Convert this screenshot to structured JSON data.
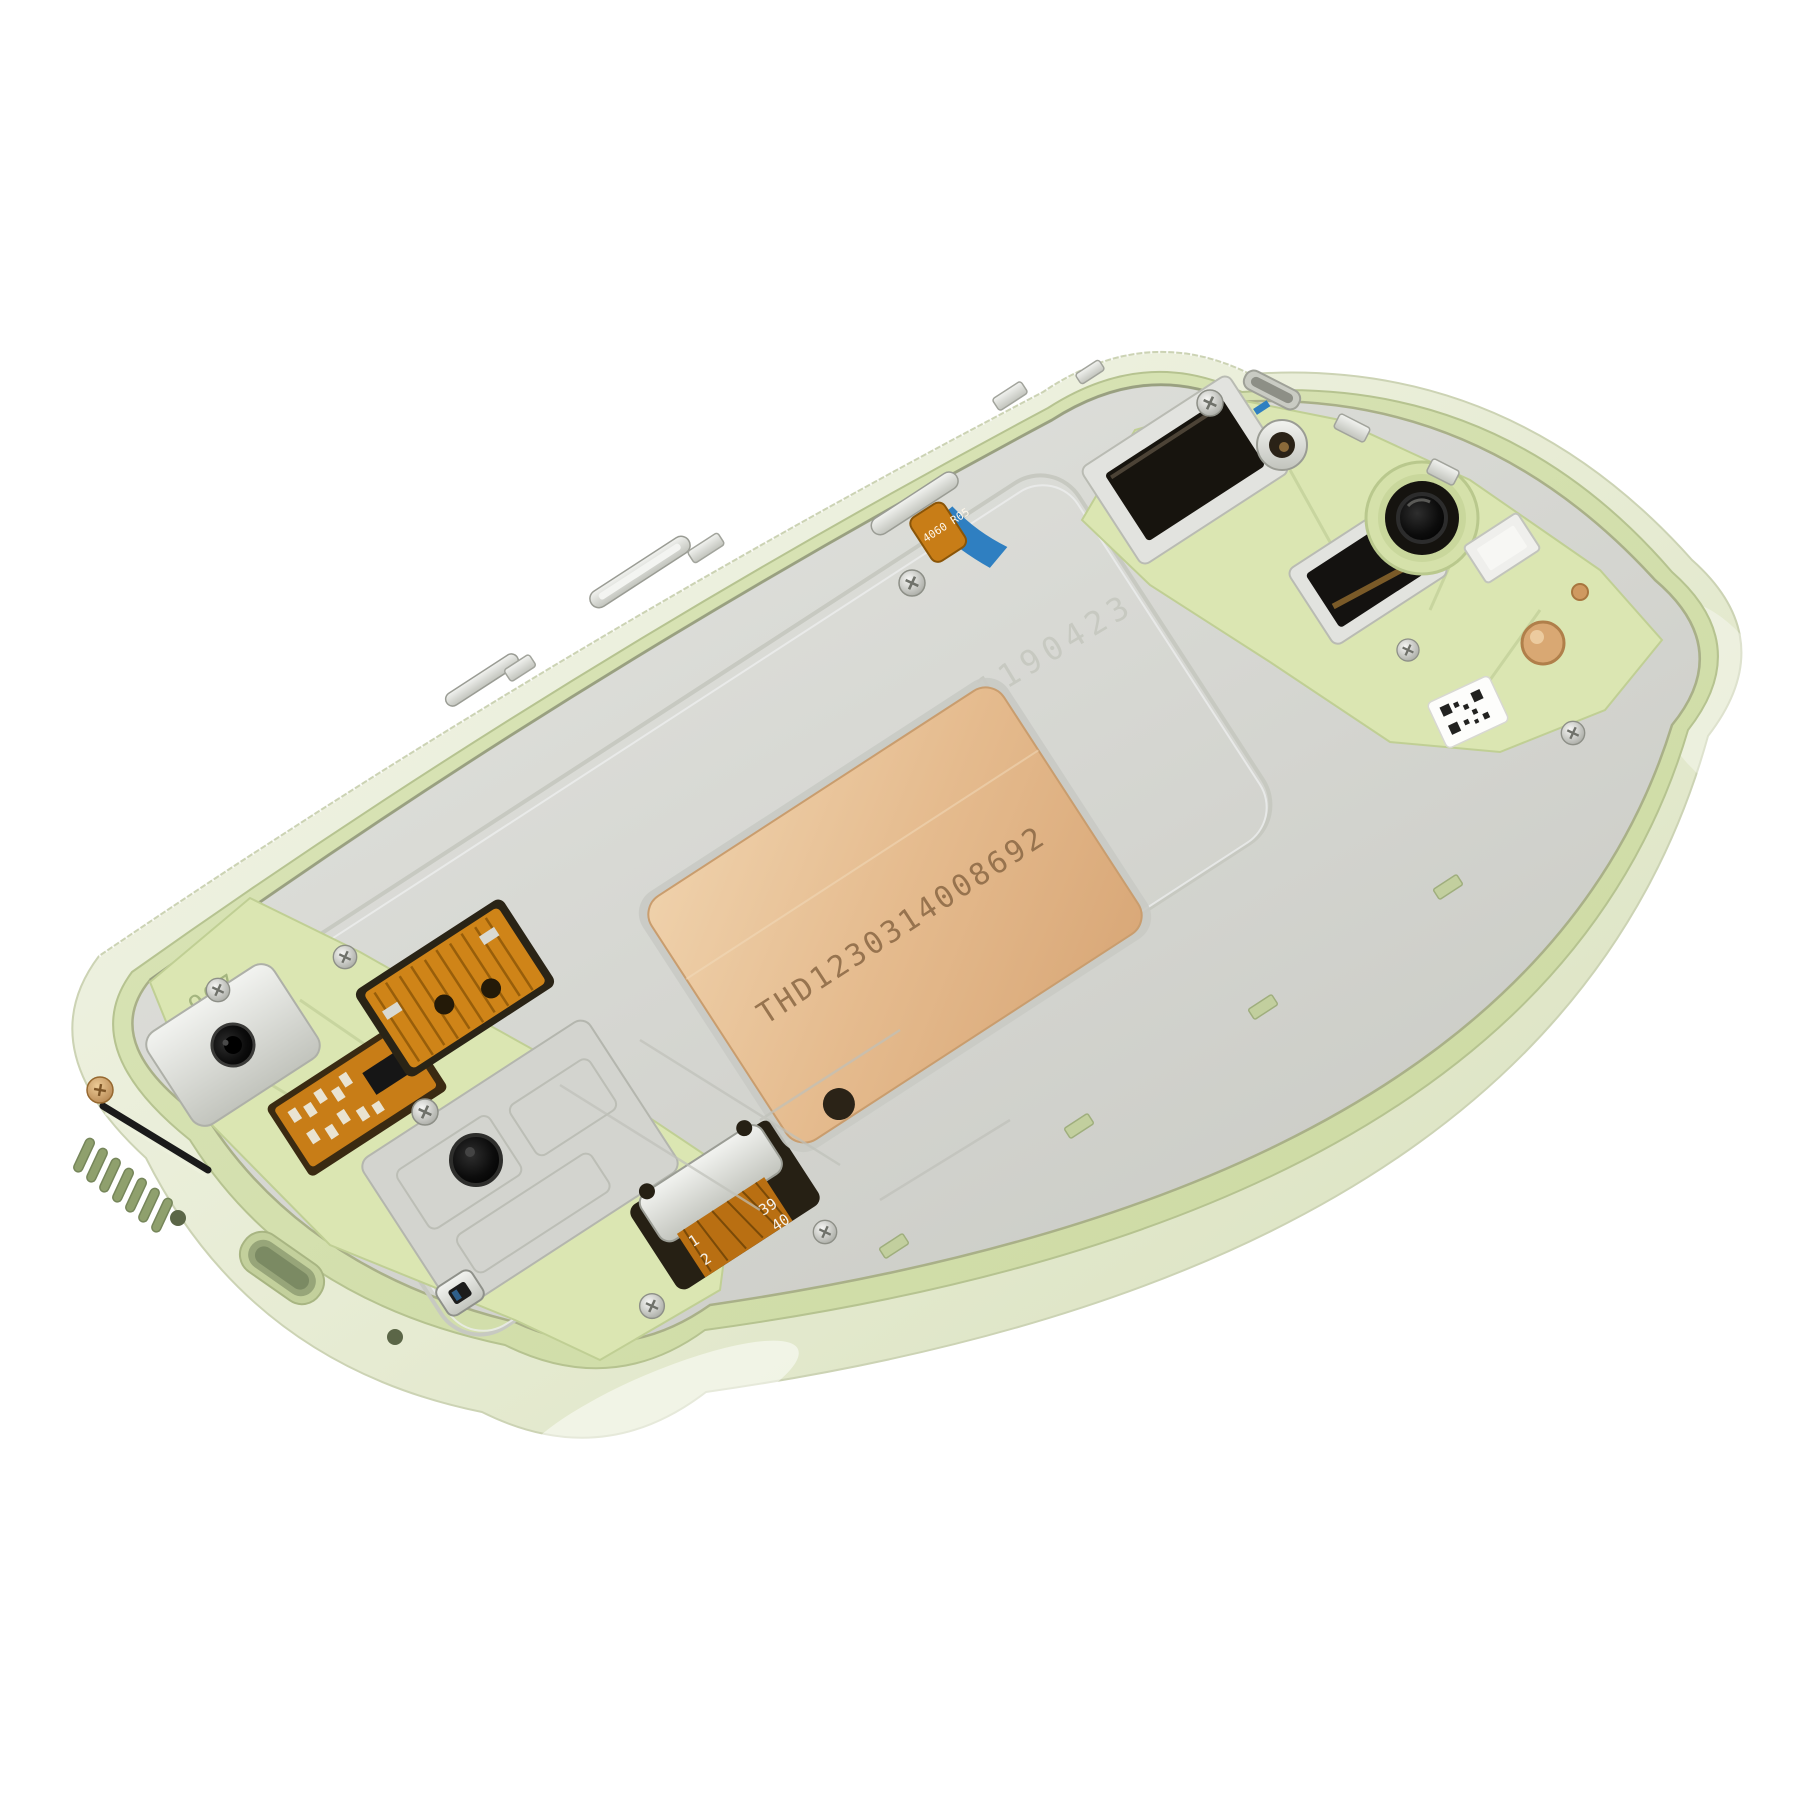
{
  "scene": {
    "description": "Product photograph of a lime-green smartphone mid-frame (chassis) shown at a diagonal 3/4 angle on a white background. The silver LCD shield plate sits inside a pale green metal frame with exposed flex cables, screws, a copper heat-shield sticker, camera and sensor openings, speaker slots and a USB-C cutout.",
    "background_color": "#ffffff"
  },
  "palette": {
    "frame_outer": "#eef1e2",
    "frame_wall": "#dde5c4",
    "inner_lip_green": "#d4e0a8",
    "plate_silver": "#d7d8d3",
    "plate_highlight": "#e7e8e4",
    "interior_lime": "#dbe6b2",
    "copper_shield": "#e5bd92",
    "flex_orange": "#c87d17",
    "flex_blue": "#2f7fc1",
    "lens_black": "#0a0a0a",
    "gold_copper": "#cf9960"
  },
  "markings": {
    "heat_shield_serial": "THD1230314008692",
    "plate_etched_serial": "1190423",
    "frame_molded_code": "907",
    "button_flex_code": "4060 R05",
    "display_connector_pins": {
      "p1": "1",
      "p2": "2",
      "p39": "39",
      "p40": "40"
    }
  },
  "counts": {
    "speaker_slots": 7,
    "visible_screws": 9
  }
}
